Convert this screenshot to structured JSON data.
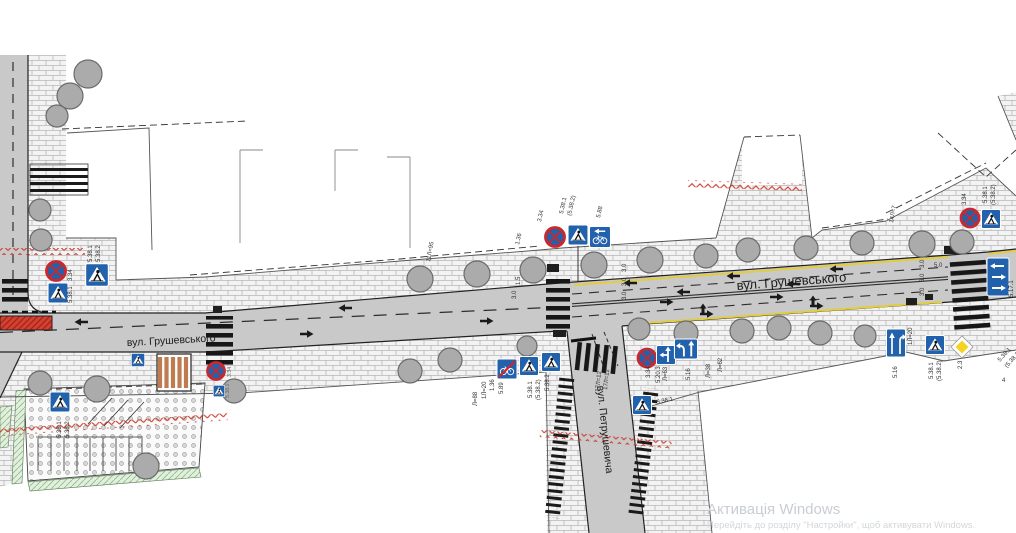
{
  "streets": {
    "hrushevskoho_left": "вул. Грушевського",
    "hrushevskoho_right": "вул. Грушевського",
    "petrushevycha": "вул. Петрушевича"
  },
  "watermark": {
    "title": "Активація Windows",
    "subtitle": "Перейдіть до розділу \"Настройки\", щоб активувати Windows."
  },
  "colors": {
    "sign_blue": "#2261ab",
    "sign_red": "#c9282f",
    "road_gray": "#c9c9c9",
    "edge_yellow": "#e2cc42",
    "zigzag_red": "#cc3b2e",
    "priority_yellow": "#f6d222"
  },
  "labels": [
    "3.34",
    "5.38.1",
    "5.38.1",
    "5.38.2",
    "5.38.1",
    "5.38.2",
    "3.34",
    "5.38.1",
    "1.36",
    "3.34",
    "5.38.1",
    "(5.38.2)",
    "5.88",
    "11Л=95",
    "1.5",
    "3.0",
    "3.0",
    "3.0",
    "3.0",
    "1.36",
    "5.89",
    "1Л=20",
    "Л=88",
    "5.38.1",
    "(5.38.2)",
    "5.38.2",
    "17Л=12",
    "17Л=12",
    "3.34",
    "5.20.3",
    "Л=63",
    "5.16",
    "Л=38",
    "Л=62",
    "5.38.1",
    "14Л=7",
    "5.0",
    "3.0",
    "3.0",
    "3.0",
    "5.16",
    "1Л=20",
    "5.38.1",
    "(5.38.2)",
    "2.3",
    "5.38.1",
    "(5.38.2)",
    "4",
    "3.34",
    "5.38.1",
    "(5.38.2)",
    "5.17.1"
  ]
}
